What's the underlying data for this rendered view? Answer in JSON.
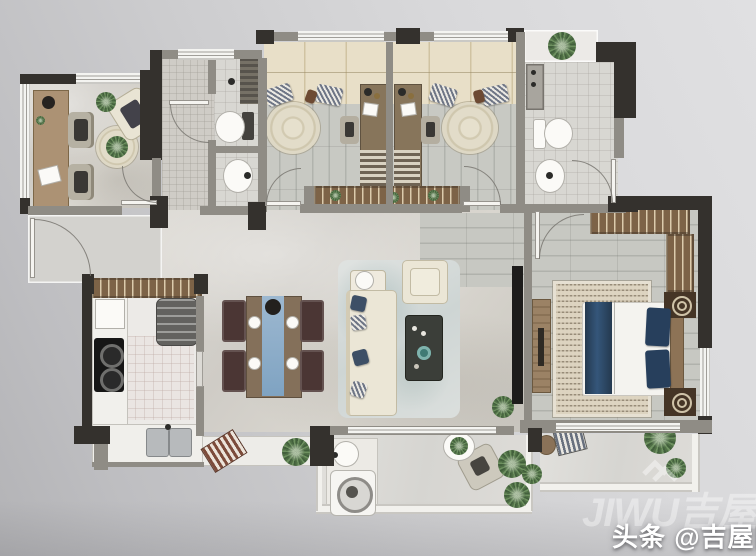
{
  "watermark": {
    "text": "头条 @吉屋网",
    "logo_text": "JIWU吉屋",
    "logo_mark": "double-chevron",
    "text_color": "#ffffff"
  },
  "palette": {
    "paper_light": "#e0e0e2",
    "paper_dark": "#b3b3b6",
    "wall_dark": "#34312d",
    "wall_gray": "#8f8c85",
    "window_white": "#f4f4f1",
    "marble_floor": "#d8d5cf",
    "wood_floor": "#c3c5bf",
    "platform_beige": "#e6dcc4",
    "wardrobe_brown": "#7d6347",
    "bed_navy": "#2f4a6b",
    "runner_blue": "#8fb3cf",
    "sofa_cream": "#ece7d8",
    "chair_maroon": "#4b3634",
    "plant_green": "#55774b"
  },
  "plan": {
    "type": "apartment-floor-plan",
    "text_labels_on_plan": false,
    "rooms": [
      {
        "id": "study",
        "furniture": [
          "long-desk",
          "two-chairs",
          "corner-armchair",
          "round-rug",
          "plants"
        ]
      },
      {
        "id": "entry-porch",
        "furniture": [
          "entry-door"
        ]
      },
      {
        "id": "entry-hall",
        "furniture": []
      },
      {
        "id": "bathroom-1",
        "furniture": [
          "shower",
          "toilet",
          "wash-basin"
        ]
      },
      {
        "id": "bedroom-1",
        "furniture": [
          "platform-wardrobe",
          "desk-bed-unit",
          "chair",
          "round-rug",
          "bay-window"
        ]
      },
      {
        "id": "bedroom-2",
        "furniture": [
          "platform-wardrobe",
          "desk-bed-unit",
          "chair",
          "round-rug",
          "bay-window"
        ]
      },
      {
        "id": "bathroom-2",
        "furniture": [
          "shower-panel",
          "toilet",
          "wash-basin",
          "plant-niche"
        ]
      },
      {
        "id": "master-bedroom",
        "furniture": [
          "double-bed",
          "navy-runner",
          "wardrobe-l",
          "nightstand-medallions",
          "tv-console",
          "patterned-rug"
        ]
      },
      {
        "id": "living-room",
        "furniture": [
          "sofa",
          "chaise-chair",
          "side-table",
          "coffee-table",
          "tv-wall",
          "area-rug",
          "floor-plant"
        ]
      },
      {
        "id": "dining-area",
        "furniture": [
          "dining-table",
          "blue-runner",
          "four-chairs",
          "shoe-bench",
          "plant"
        ]
      },
      {
        "id": "kitchen",
        "furniture": [
          "l-counter",
          "gas-stove",
          "refrigerator",
          "double-sink",
          "floor-mat",
          "bay-ledge"
        ]
      },
      {
        "id": "laundry-balcony",
        "furniture": [
          "washing-machine",
          "laundry-basin",
          "round-table",
          "armchair",
          "plants"
        ]
      },
      {
        "id": "master-balcony",
        "furniture": [
          "lounge-bench",
          "side-table",
          "plants"
        ]
      }
    ]
  }
}
